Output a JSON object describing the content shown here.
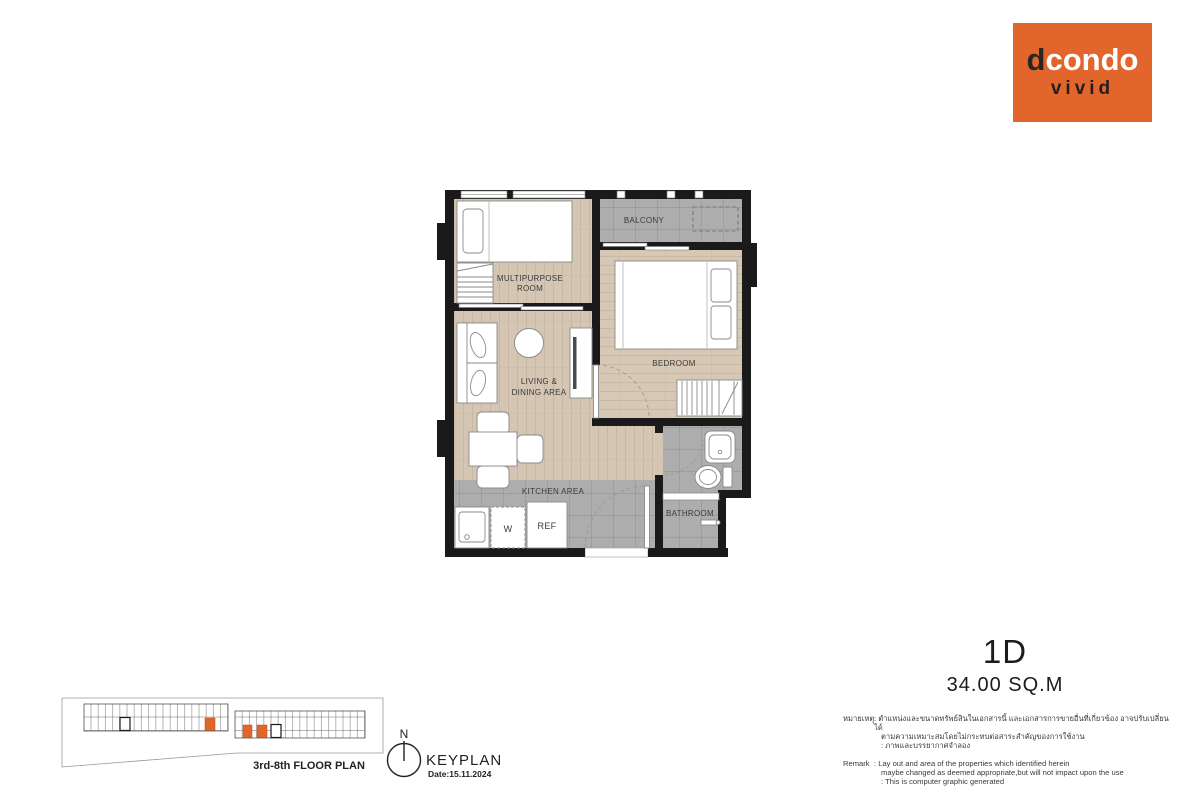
{
  "logo": {
    "brand_d": "d",
    "brand_rest": "condo",
    "sub": "vivid",
    "bg_color": "#E2662B"
  },
  "unit": {
    "name": "1D",
    "area": "34.00 SQ.M"
  },
  "floorplan": {
    "labels": {
      "multipurpose_1": "MULTIPURPOSE",
      "multipurpose_2": "ROOM",
      "balcony": "BALCONY",
      "bedroom": "BEDROOM",
      "living_1": "LIVING &",
      "living_2": "DINING AREA",
      "kitchen": "KITCHEN AREA",
      "bathroom": "BATHROOM",
      "washer": "W",
      "fridge": "REF"
    },
    "colors": {
      "wall": "#1a1a1a",
      "wood_floor": "#d4c6b2",
      "tile_floor": "#adadad"
    }
  },
  "keyplan": {
    "title": "KEYPLAN",
    "date": "Date:15.11.2024",
    "floor_label": "3rd-8th  FLOOR PLAN",
    "north": "N",
    "highlight_color": "#E2662B"
  },
  "remarks": {
    "thai_label": "หมายเหตุ",
    "thai_lines": [
      ": ตำแหน่งและขนาดทรัพย์สินในเอกสารนี้ และเอกสารการขายอื่นที่เกี่ยวข้อง อาจปรับเปลี่ยนได้",
      "ตามความเหมาะสมโดยไม่กระทบต่อสาระสำคัญของการใช้งาน",
      ": ภาพและบรรยากาศจำลอง"
    ],
    "en_label": "Remark",
    "en_lines": [
      ": Lay out and area of the properties which identified herein",
      "maybe changed as deemed appropriate,but will not impact upon the use",
      ": This is computer graphic generated"
    ]
  }
}
